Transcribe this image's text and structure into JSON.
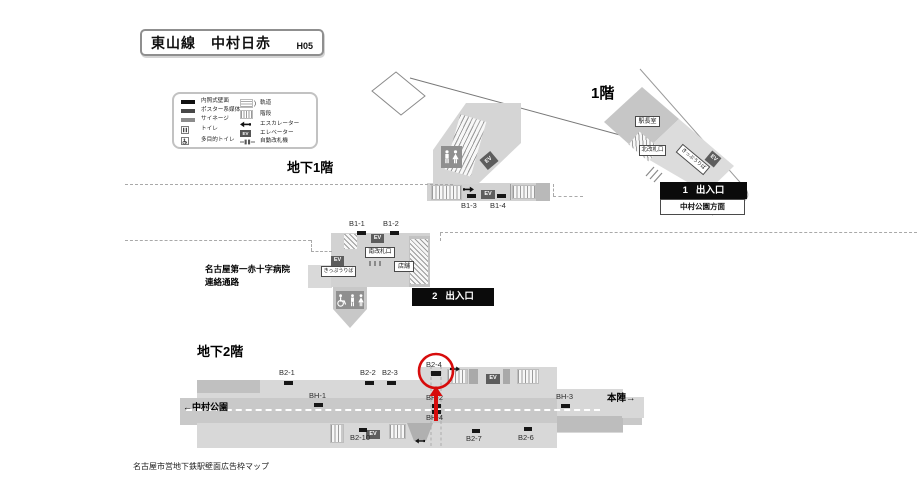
{
  "title": {
    "name": "東山線　中村日赤",
    "code": "H05"
  },
  "legend": {
    "left": [
      "内照式壁面",
      "ポスター系媒体",
      "サイネージ",
      "トイレ",
      "多目的トイレ"
    ],
    "right": [
      "軌道",
      "階段",
      "エスカレーター",
      "エレベーター",
      "自動改札機"
    ],
    "track_suffix": ")"
  },
  "f1": {
    "label": "1階",
    "office": "駅長室",
    "north_gate": "北改札口",
    "ticket_area": "きっぷうりば",
    "exit_no": "1",
    "exit": "出入口",
    "exit_direction": "中村公園方面"
  },
  "b1f": {
    "label": "地下1階",
    "spot_b1_3": "B1-3",
    "spot_b1_4": "B1-4"
  },
  "concourse": {
    "spot_b1_1": "B1-1",
    "spot_b1_2": "B1-2",
    "south_gate": "南改札口",
    "shop": "店舗",
    "ticket_area": "きっぷうりば",
    "exit_no": "2",
    "exit": "出入口",
    "hospital_line1": "名古屋第一赤十字病院",
    "hospital_line2": "連絡通路"
  },
  "b2f": {
    "label": "地下2階",
    "spot_b2_1": "B2-1",
    "spot_b2_2": "B2-2",
    "spot_b2_3": "B2-3",
    "spot_b2_4": "B2-4",
    "spot_bh_1": "BH-1",
    "spot_bh_2": "BH-2",
    "spot_bh_3": "BH-3",
    "spot_bh_4": "BH-4",
    "spot_b2_10": "B2-10",
    "spot_b2_7": "B2-7",
    "spot_b2_6": "B2-6",
    "direction_left": "←中村公園",
    "direction_right": "本陣→"
  },
  "ev": "EV",
  "footer": "名古屋市営地下鉄駅壁面広告枠マップ",
  "colors": {
    "highlight_red": "#d70c0c",
    "platform_light": "#d8d8d8",
    "platform_mid": "#c9c9c9",
    "bar_black": "#161616"
  }
}
